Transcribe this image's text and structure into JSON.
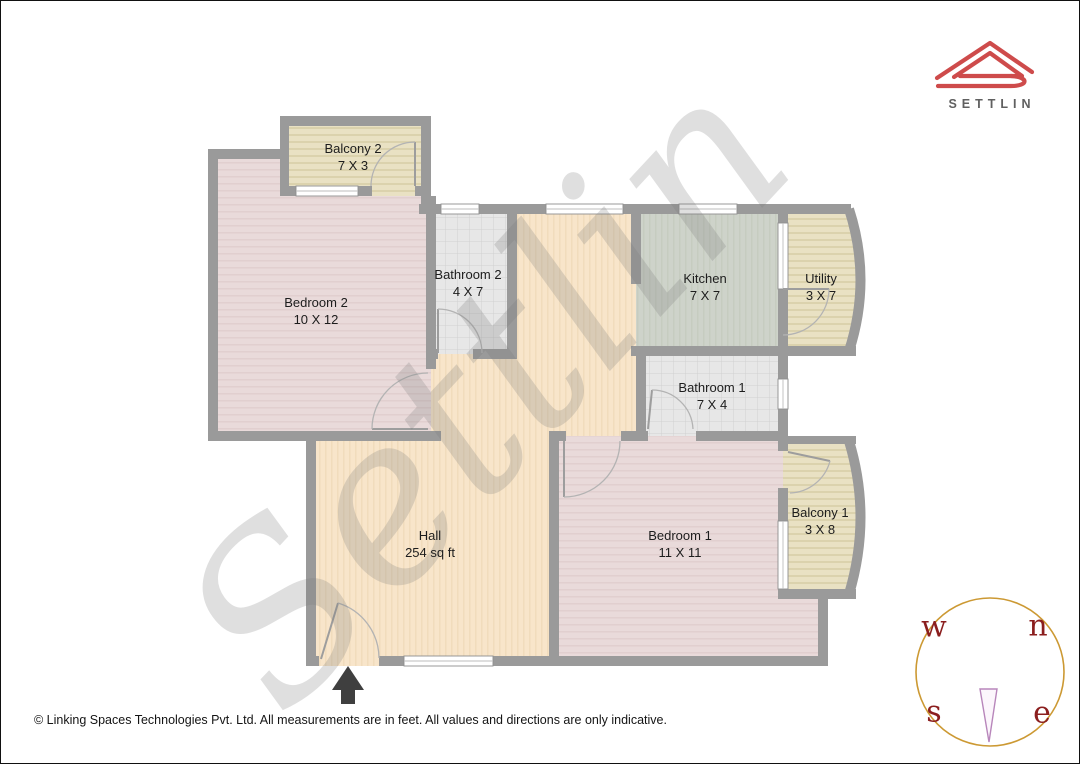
{
  "brand": {
    "name": "SETTLIN"
  },
  "watermark": {
    "text": "Settlin"
  },
  "plan": {
    "rooms": [
      {
        "key": "balcony-2",
        "name": "Balcony 2",
        "dims": "7 X 3"
      },
      {
        "key": "bedroom-2",
        "name": "Bedroom 2",
        "dims": "10 X 12"
      },
      {
        "key": "bathroom-2",
        "name": "Bathroom 2",
        "dims": "4 X 7"
      },
      {
        "key": "kitchen",
        "name": "Kitchen",
        "dims": "7 X 7"
      },
      {
        "key": "utility",
        "name": "Utility",
        "dims": "3 X 7"
      },
      {
        "key": "bathroom-1",
        "name": "Bathroom 1",
        "dims": "7 X 4"
      },
      {
        "key": "hall",
        "name": "Hall",
        "dims": "254 sq ft"
      },
      {
        "key": "bedroom-1",
        "name": "Bedroom 1",
        "dims": "11 X 11"
      },
      {
        "key": "balcony-1",
        "name": "Balcony 1",
        "dims": "3 X 8"
      }
    ]
  },
  "compass": {
    "west": "w",
    "north": "n",
    "south": "s",
    "east": "e"
  },
  "footer": {
    "copyright": "© Linking Spaces Technologies Pvt. Ltd. All measurements are in feet. All values and directions are only indicative."
  },
  "colors": {
    "logo_red": "#ce4b4b",
    "brand_text": "#606060",
    "wall": "#9a9a9a",
    "bedroom_floor": "#e9dada",
    "hall_floor": "#f8e5ca",
    "balcony_floor": "#e9e1c3",
    "bathroom_floor": "#e7e7e7",
    "kitchen_floor": "#ced3ca",
    "compass_ring": "#cc9933",
    "compass_letters": "#8b1e1e",
    "compass_needle": "#b886bb",
    "entrance_arrow": "#3f3f3f"
  }
}
